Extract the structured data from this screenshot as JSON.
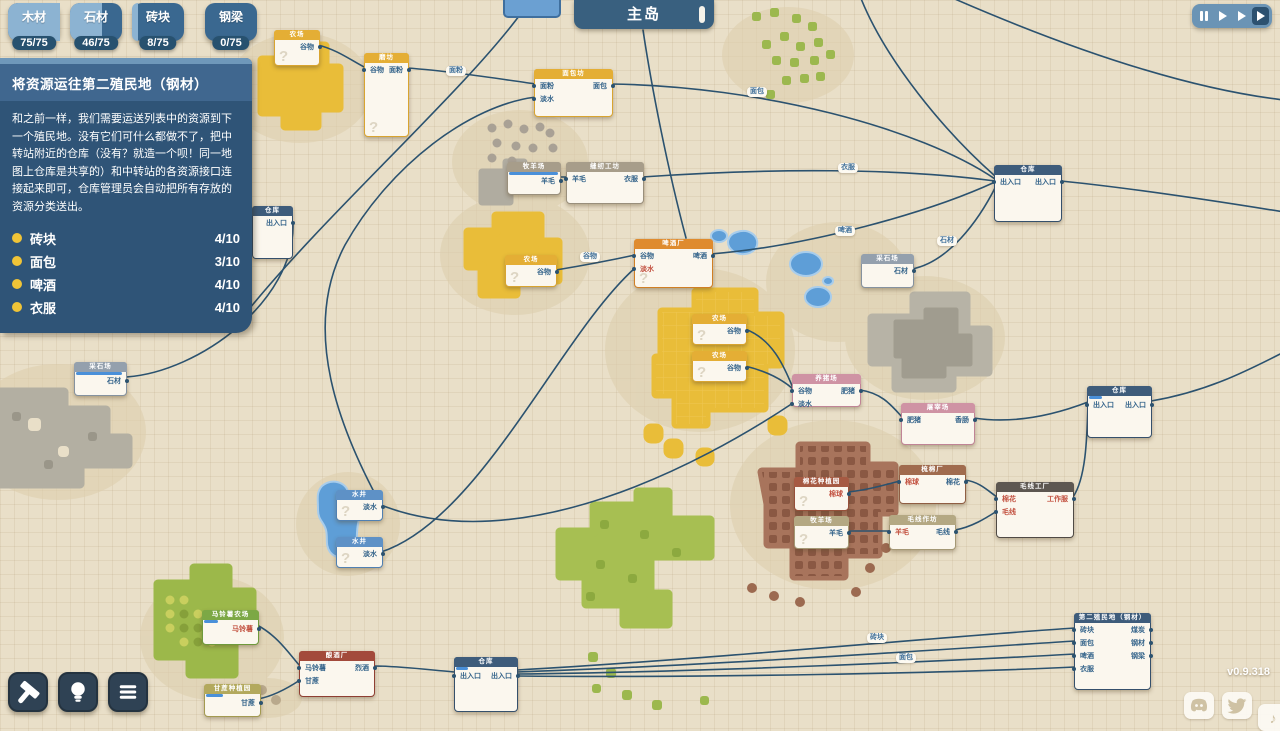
{
  "hud": {
    "resources": [
      {
        "name": "木材",
        "count": "75/75",
        "pct": 100
      },
      {
        "name": "石材",
        "count": "46/75",
        "pct": 61
      },
      {
        "name": "砖块",
        "count": "8/75",
        "pct": 11
      },
      {
        "name": "钢梁",
        "count": "0/75",
        "pct": 0
      }
    ],
    "quest": {
      "title": "将资源运往第二殖民地（钢材）",
      "body": "和之前一样，我们需要运送列表中的资源到下一个殖民地。没有它们可什么都做不了，把中转站附近的仓库（没有？就造一个呗！同一地图上仓库是共享的）和中转站的各资源接口连接起来即可，仓库管理员会自动把所有存放的资源分类送出。",
      "items": [
        {
          "label": "砖块",
          "progress": "4/10"
        },
        {
          "label": "面包",
          "progress": "3/10"
        },
        {
          "label": "啤酒",
          "progress": "4/10"
        },
        {
          "label": "衣服",
          "progress": "4/10"
        }
      ]
    },
    "island_tab": "主岛",
    "playback": [
      "pause-icon",
      "play-icon",
      "fast-forward-icon",
      "fastest-icon"
    ],
    "tools": [
      "build-hammer-icon",
      "hint-bulb-icon",
      "menu-icon"
    ],
    "social": [
      "discord-icon",
      "twitter-icon",
      "music-icon"
    ],
    "version": "v0.9.318",
    "colors": {
      "accent_blue": "#6b94b5",
      "panel": "#2f5477",
      "bullet_yellow": "#f0c437",
      "wire": "#2b526f",
      "port_blue": "#33638a",
      "port_red": "#c2503f"
    }
  },
  "map": {
    "nodes": [
      {
        "id": "farm-top",
        "title": "农场",
        "color": "yellow",
        "x": 274,
        "y": 30,
        "w": 46,
        "h": 36,
        "rows": [
          {
            "r": "谷物"
          }
        ],
        "q": true
      },
      {
        "id": "mill",
        "title": "磨坊",
        "color": "yellow",
        "x": 364,
        "y": 53,
        "w": 45,
        "h": 84,
        "rows": [
          {
            "l": "谷物",
            "r": "面粉"
          }
        ],
        "q": true
      },
      {
        "id": "bakery",
        "title": "面包坊",
        "color": "yellow",
        "x": 534,
        "y": 69,
        "w": 79,
        "h": 48,
        "rows": [
          {
            "l": "面粉",
            "r": "面包"
          },
          {
            "l": "淡水"
          }
        ]
      },
      {
        "id": "sheep-farm-1",
        "title": "牧羊场",
        "color": "taupe",
        "x": 507,
        "y": 162,
        "w": 54,
        "h": 33,
        "rows": [
          {
            "r": "羊毛"
          }
        ],
        "prog": 0.95
      },
      {
        "id": "sewing",
        "title": "缝纫工坊",
        "color": "taupe",
        "x": 566,
        "y": 162,
        "w": 78,
        "h": 42,
        "rows": [
          {
            "l": "羊毛",
            "r": "衣服"
          }
        ]
      },
      {
        "id": "farm-mid",
        "title": "农场",
        "color": "yellow",
        "x": 505,
        "y": 255,
        "w": 52,
        "h": 32,
        "rows": [
          {
            "r": "谷物"
          }
        ],
        "q": true
      },
      {
        "id": "brewery",
        "title": "啤酒厂",
        "color": "orange",
        "x": 634,
        "y": 239,
        "w": 79,
        "h": 49,
        "rows": [
          {
            "l": "谷物",
            "r": "啤酒"
          },
          {
            "l": "淡水",
            "lred": true
          }
        ],
        "q": true
      },
      {
        "id": "farm-1",
        "title": "农场",
        "color": "yellow",
        "x": 692,
        "y": 314,
        "w": 55,
        "h": 31,
        "rows": [
          {
            "r": "谷物"
          }
        ],
        "q": true
      },
      {
        "id": "farm-2",
        "title": "农场",
        "color": "yellow",
        "x": 692,
        "y": 351,
        "w": 55,
        "h": 31,
        "rows": [
          {
            "r": "谷物"
          }
        ],
        "q": true
      },
      {
        "id": "pig-farm",
        "title": "养猪场",
        "color": "pink",
        "x": 792,
        "y": 374,
        "w": 69,
        "h": 33,
        "rows": [
          {
            "l": "谷物",
            "r": "肥猪"
          },
          {
            "l": "淡水"
          }
        ]
      },
      {
        "id": "butcher",
        "title": "屠宰场",
        "color": "pink",
        "x": 901,
        "y": 403,
        "w": 74,
        "h": 42,
        "rows": [
          {
            "l": "肥猪",
            "r": "香肠"
          }
        ]
      },
      {
        "id": "quarry-right",
        "title": "采石场",
        "color": "grayblue",
        "x": 861,
        "y": 254,
        "w": 53,
        "h": 34,
        "rows": [
          {
            "r": "石材"
          }
        ]
      },
      {
        "id": "warehouse-1",
        "title": "仓库",
        "color": "navy",
        "x": 994,
        "y": 165,
        "w": 68,
        "h": 57,
        "rows": [
          {
            "l": "出入口",
            "r": "出入口"
          }
        ]
      },
      {
        "id": "warehouse-2",
        "title": "仓库",
        "color": "navy",
        "x": 1087,
        "y": 386,
        "w": 65,
        "h": 52,
        "rows": [
          {
            "l": "出入口",
            "r": "出入口"
          }
        ],
        "prog": 0.2
      },
      {
        "id": "cotton-plantation",
        "title": "棉花种植园",
        "color": "rust",
        "x": 794,
        "y": 477,
        "w": 55,
        "h": 34,
        "rows": [
          {
            "r": "棉球",
            "rred": true
          }
        ],
        "q": true
      },
      {
        "id": "carding-mill",
        "title": "梳棉厂",
        "color": "brown",
        "x": 899,
        "y": 465,
        "w": 67,
        "h": 39,
        "rows": [
          {
            "l": "棉球",
            "lred": true,
            "r": "棉花"
          }
        ]
      },
      {
        "id": "sheep-farm-2",
        "title": "牧羊场",
        "color": "tan",
        "x": 794,
        "y": 516,
        "w": 55,
        "h": 33,
        "rows": [
          {
            "r": "羊毛"
          }
        ],
        "q": true
      },
      {
        "id": "yarn-workshop",
        "title": "毛线作坊",
        "color": "tan",
        "x": 889,
        "y": 515,
        "w": 67,
        "h": 35,
        "rows": [
          {
            "l": "羊毛",
            "lred": true,
            "r": "毛线"
          }
        ]
      },
      {
        "id": "textile-factory",
        "title": "毛线工厂",
        "color": "charcoal",
        "x": 996,
        "y": 482,
        "w": 78,
        "h": 56,
        "rows": [
          {
            "l": "棉花",
            "lred": true,
            "r": "工作服",
            "rred": true
          },
          {
            "l": "毛线",
            "lred": true
          }
        ]
      },
      {
        "id": "quarry-left",
        "title": "采石场",
        "color": "grayblue",
        "x": 74,
        "y": 362,
        "w": 53,
        "h": 34,
        "rows": [
          {
            "r": "石材"
          }
        ],
        "prog": 0.9
      },
      {
        "id": "warehouse-3",
        "title": "仓库",
        "color": "navy",
        "x": 252,
        "y": 206,
        "w": 41,
        "h": 53,
        "rows": [
          {
            "r": "出入口"
          }
        ]
      },
      {
        "id": "well-1",
        "title": "水井",
        "color": "blue",
        "x": 336,
        "y": 490,
        "w": 47,
        "h": 31,
        "rows": [
          {
            "r": "淡水"
          }
        ],
        "q": true
      },
      {
        "id": "well-2",
        "title": "水井",
        "color": "blue",
        "x": 336,
        "y": 537,
        "w": 47,
        "h": 31,
        "rows": [
          {
            "r": "淡水"
          }
        ],
        "q": true
      },
      {
        "id": "potato-farm",
        "title": "马铃薯农场",
        "color": "green",
        "x": 202,
        "y": 610,
        "w": 57,
        "h": 35,
        "rows": [
          {
            "r": "马铃薯",
            "rred": true
          }
        ],
        "prog": 0.25
      },
      {
        "id": "distillery",
        "title": "酿酒厂",
        "color": "darkred",
        "x": 299,
        "y": 651,
        "w": 76,
        "h": 46,
        "rows": [
          {
            "l": "马铃薯",
            "r": "烈酒"
          },
          {
            "l": "甘蔗"
          }
        ]
      },
      {
        "id": "cane-plantation",
        "title": "甘蔗种植园",
        "color": "olive",
        "x": 204,
        "y": 684,
        "w": 57,
        "h": 33,
        "rows": [
          {
            "r": "甘蔗"
          }
        ],
        "prog": 0.3
      },
      {
        "id": "warehouse-4",
        "title": "仓库",
        "color": "navy",
        "x": 454,
        "y": 657,
        "w": 64,
        "h": 55,
        "rows": [
          {
            "l": "出入口",
            "r": "出入口"
          }
        ],
        "prog": 0.2
      },
      {
        "id": "second-colony",
        "title": "第二殖民地（钢材）",
        "color": "navy",
        "x": 1074,
        "y": 613,
        "w": 77,
        "h": 77,
        "rows": [
          {
            "l": "砖块",
            "r": "煤炭"
          },
          {
            "l": "面包",
            "r": "钢材"
          },
          {
            "l": "啤酒",
            "r": "钢梁"
          },
          {
            "l": "衣服"
          }
        ]
      }
    ],
    "edges": [
      {
        "d": "M318,45 C338,50 352,61 366,68"
      },
      {
        "d": "M407,68 C450,71 500,79 536,84",
        "label": "面粉",
        "lx": 456,
        "ly": 71
      },
      {
        "d": "M611,84 C760,86 920,128 995,179",
        "label": "面包",
        "lx": 757,
        "ly": 92
      },
      {
        "d": "M642,177 C770,168 900,168 995,181",
        "label": "衣服",
        "lx": 848,
        "ly": 168
      },
      {
        "d": "M711,254 C810,246 930,212 995,182",
        "label": "啤酒",
        "lx": 845,
        "ly": 231
      },
      {
        "d": "M912,269 C948,262 978,222 996,186",
        "label": "石材",
        "lx": 947,
        "ly": 241
      },
      {
        "d": "M860,-4 C885,60 945,132 995,176"
      },
      {
        "d": "M948,-4 C1060,45 1180,88 1284,100"
      },
      {
        "d": "M643,30 C652,90 668,170 686,238"
      },
      {
        "d": "M522,12 C465,90 330,210 250,308"
      },
      {
        "d": "M556,270 C580,266 612,260 635,255",
        "label": "谷物",
        "lx": 590,
        "ly": 257
      },
      {
        "d": "M381,505 C340,430 300,330 345,245 C390,165 470,105 536,97"
      },
      {
        "d": "M381,552 C480,520 560,335 635,268"
      },
      {
        "d": "M381,505 C520,560 700,465 793,403"
      },
      {
        "d": "M559,177 L567,177"
      },
      {
        "d": "M745,329 C775,340 786,372 793,388"
      },
      {
        "d": "M745,366 C770,372 784,381 793,389"
      },
      {
        "d": "M860,390 C882,393 892,406 902,417"
      },
      {
        "d": "M974,418 C1020,425 1062,412 1088,402"
      },
      {
        "d": "M1073,497 C1086,478 1087,438 1088,404"
      },
      {
        "d": "M848,492 C868,490 884,485 900,481"
      },
      {
        "d": "M965,480 C980,482 988,491 997,497"
      },
      {
        "d": "M848,531 C862,531 876,531 890,531"
      },
      {
        "d": "M955,530 C972,527 986,518 997,511"
      },
      {
        "d": "M126,377 C200,372 295,300 293,224"
      },
      {
        "d": "M257,625 C278,636 290,655 300,666"
      },
      {
        "d": "M258,699 C274,696 288,688 300,680"
      },
      {
        "d": "M374,666 C400,666 430,670 455,672"
      },
      {
        "d": "M517,670 C700,660 950,636 1075,628",
        "label": "砖块",
        "lx": 877,
        "ly": 638
      },
      {
        "d": "M517,672 C700,666 950,649 1075,641"
      },
      {
        "d": "M517,674 C700,672 950,661 1075,654",
        "label": "面包",
        "lx": 906,
        "ly": 658
      },
      {
        "d": "M517,676 C700,678 950,673 1075,667"
      },
      {
        "d": "M1061,181 C1130,188 1210,200 1284,212"
      },
      {
        "d": "M1151,401 C1205,392 1245,372 1284,352"
      }
    ]
  }
}
